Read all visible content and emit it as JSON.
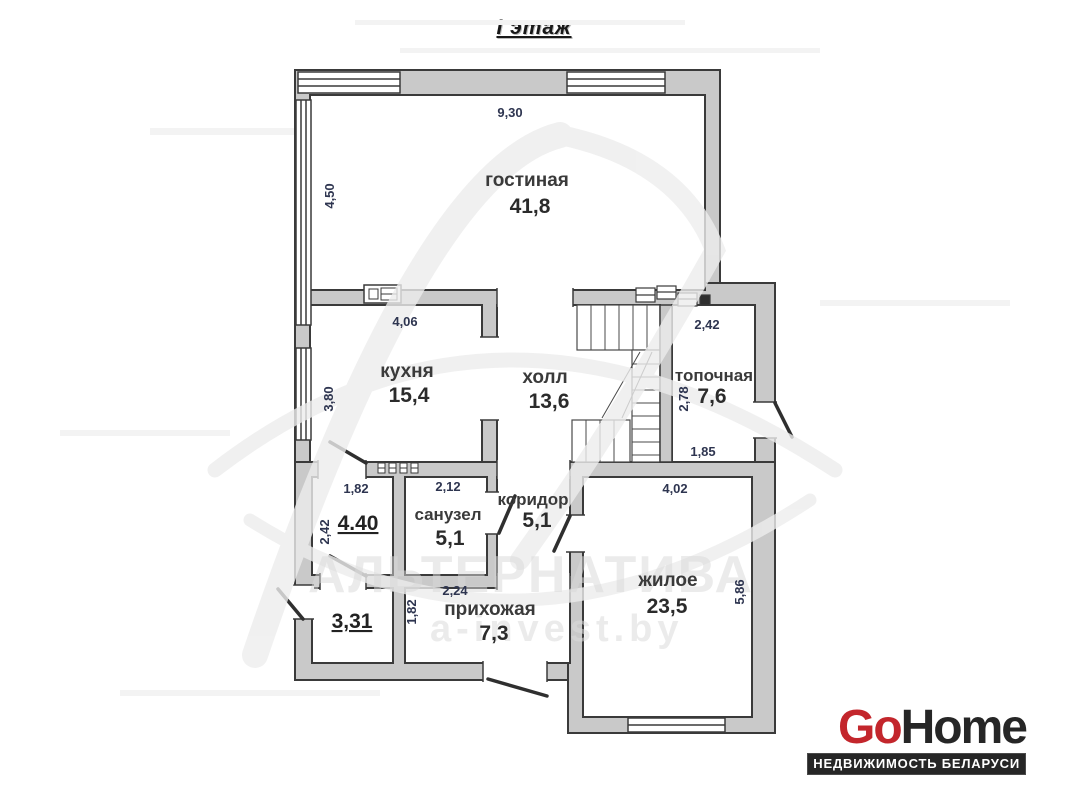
{
  "page": {
    "title": "I этаж"
  },
  "plan": {
    "rooms": {
      "gostinaya": {
        "name": "гостиная",
        "area": "41,8",
        "width": "9,30",
        "height": "4,50"
      },
      "kuhnya": {
        "name": "кухня",
        "area": "15,4",
        "width": "4,06",
        "height": "3,80"
      },
      "holl": {
        "name": "холл",
        "area": "13,6"
      },
      "topochnaya": {
        "name": "топочная",
        "area": "7,6",
        "width": "2,42",
        "height": "2,78",
        "bottom": "1,85"
      },
      "sanuzel": {
        "name": "санузел",
        "area": "5,1",
        "width": "2,12"
      },
      "koridor": {
        "name": "коридор",
        "area": "5,1"
      },
      "prihozhaya": {
        "name": "прихожая",
        "area": "7,3",
        "width": "2,24",
        "height": "1,82"
      },
      "zhiloe": {
        "name": "жилое",
        "area": "23,5",
        "width": "4,02",
        "height": "5,86"
      },
      "porch_top": {
        "area": "4.40",
        "width": "1,82",
        "height": "2,42"
      },
      "porch_bottom": {
        "area": "3,31"
      }
    }
  },
  "watermark": {
    "line1": "АЛЬТЕРНАТИВА",
    "line2": "a-invest.by"
  },
  "logo": {
    "part1": "Go",
    "part2": "Home",
    "tagline": "НЕДВИЖИМОСТЬ БЕЛАРУСИ"
  },
  "colors": {
    "wall": "#c9c9c9",
    "outline": "#3a3a3a",
    "dim_text": "#2e3550",
    "logo_red": "#c3262c",
    "logo_dark": "#262626"
  }
}
